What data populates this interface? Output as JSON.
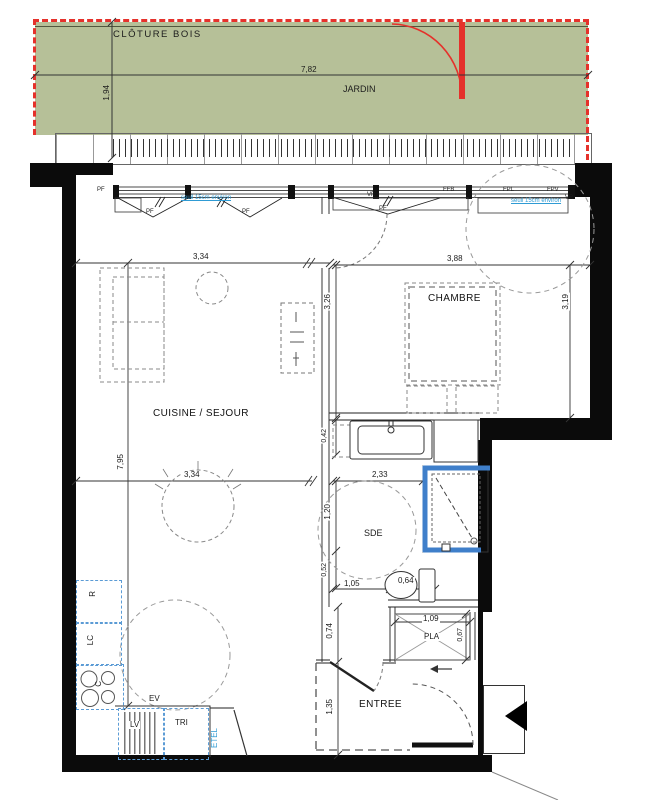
{
  "plan": {
    "garden": {
      "fence_label": "CLÔTURE BOIS",
      "name": "JARDIN",
      "width": "7,82",
      "depth": "1,94"
    },
    "rooms": {
      "living": "CUISINE / SEJOUR",
      "bedroom": "CHAMBRE",
      "bathroom": "SDE",
      "entry": "ENTREE",
      "closet": "PLA"
    },
    "openings": {
      "pf_a": "PF",
      "pf_b": "PF",
      "pf_c": "PF",
      "pf_d": "PF",
      "vr_left": "VR",
      "vr_right": "VR",
      "ffb": "FFB",
      "fpl": "FPL",
      "fpv": "FPV",
      "seuil": "seuil 15cm environ"
    },
    "kitchen": {
      "fridge": "R",
      "lc": "LC",
      "hob": "C",
      "sink": "EV",
      "dishwasher": "LV",
      "waste": "TRI",
      "etel": "ETEL"
    },
    "dims": {
      "living_w": "3,34",
      "living_w2": "3,34",
      "living_h": "7,95",
      "bedroom_w": "3,88",
      "bedroom_h_w": "3,26",
      "bedroom_h_e": "3,19",
      "bath_w": "2,33",
      "bath_h": "1,20",
      "bath_s1": "0,42",
      "bath_s2": "0,52",
      "wc_w": "1,05",
      "wc_w2": "0,64",
      "closet_w": "1,09",
      "closet_d": "0,67",
      "hall_h": "0,74",
      "entry_h": "1,35"
    },
    "colors": {
      "garden_green": "#b6c098",
      "fence_red": "#e5312b",
      "note_blue": "#2f9bd4",
      "appliance_blue": "#5b9bd5",
      "shower_blue": "#3f7fca"
    }
  }
}
